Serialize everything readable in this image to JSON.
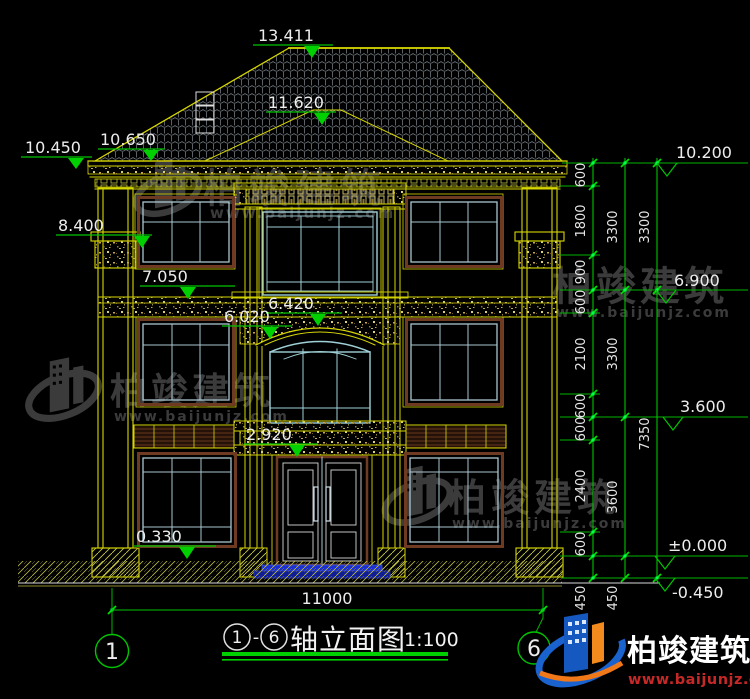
{
  "colors": {
    "line_yellow": "#d6d600",
    "dim_green": "#00c400",
    "text_white": "#ededed",
    "mullion_blue": "#a9c6cf",
    "frame_brown": "#6e3a22",
    "step_blue": "#2233cc",
    "watermark_gray": "#3b3b3b",
    "logo_blue": "#1a63cf",
    "logo_orange": "#f07818",
    "url_red": "#c62828"
  },
  "levels_left": [
    "13.411",
    "11.620",
    "10.450",
    "10.650",
    "8.400",
    "7.050",
    "6.420",
    "6.020",
    "2.920",
    "0.330"
  ],
  "levels_right": [
    "10.200",
    "6.900",
    "3.600",
    "±0.000",
    "-0.450"
  ],
  "dims_right_inner": [
    "600",
    "1800",
    "900",
    "600",
    "2100",
    "600",
    "600",
    "2400",
    "600",
    "450"
  ],
  "dims_right_mid": [
    "3300",
    "3300",
    "3600",
    "450"
  ],
  "dims_right_outer": [
    "3300",
    "7350"
  ],
  "dim_bottom": {
    "width": "11000"
  },
  "axes": {
    "left": "1",
    "right": "6"
  },
  "title": {
    "axis_from": "1",
    "dash": "-",
    "axis_to": "6",
    "name": "轴立面图",
    "scale": "1:100"
  },
  "watermark": {
    "brand": "柏竣建筑",
    "url": "www.baijunjz.com"
  },
  "logo": {
    "brand": "柏竣建筑",
    "url": "www.baijunjz.com"
  }
}
